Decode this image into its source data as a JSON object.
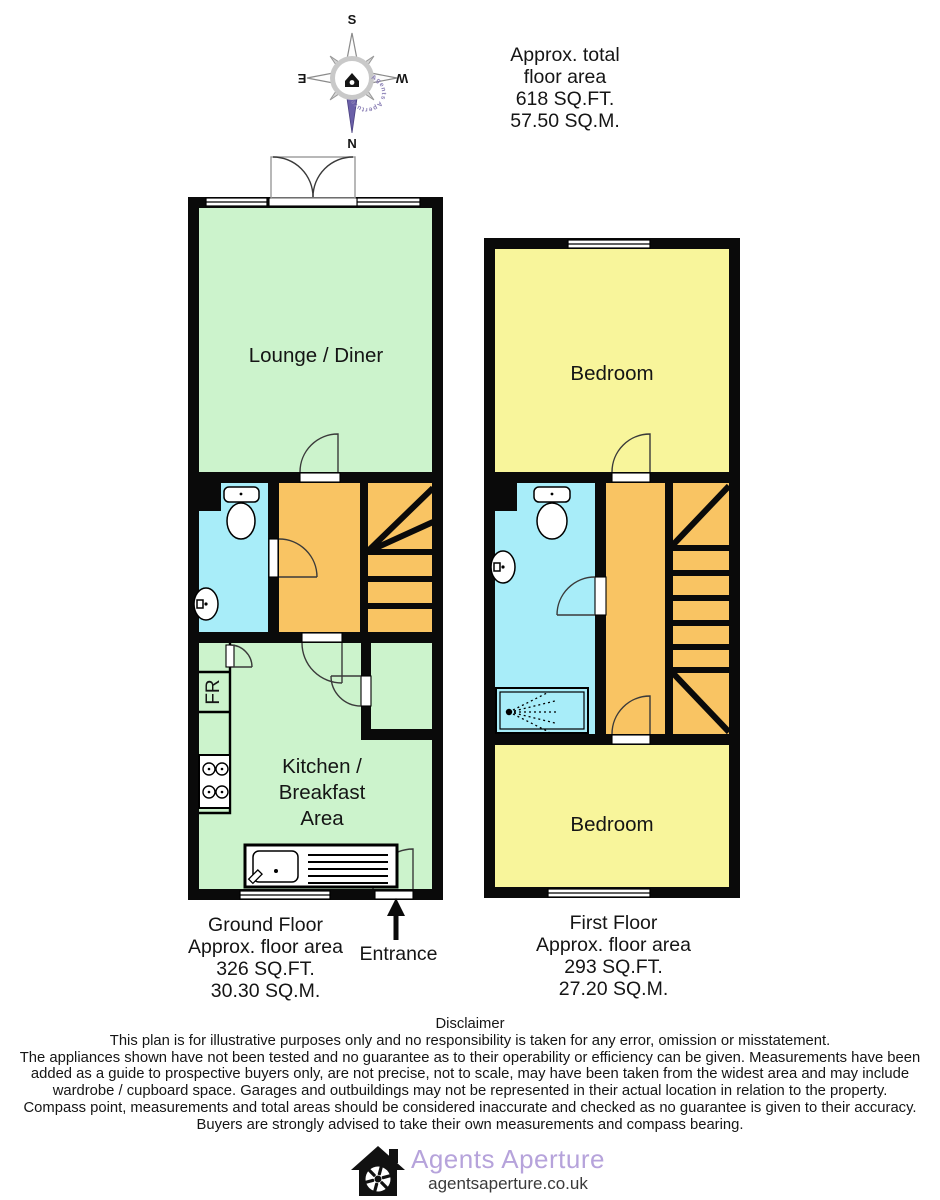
{
  "header": {
    "lines": [
      "Approx. total",
      "floor area",
      "618 SQ.FT.",
      "57.50 SQ.M."
    ]
  },
  "compass": {
    "north": "N",
    "south": "S",
    "east": "E",
    "west": "W",
    "ring_text": "Agents Aperture",
    "needle_color": "#6a5fa8"
  },
  "colors": {
    "wall": "#0a0a0a",
    "green": "#ccf3cc",
    "yellow": "#f8f59b",
    "cyan": "#a8edf9",
    "orange": "#f9c463"
  },
  "ground_floor": {
    "lounge_label": "Lounge / Diner",
    "kitchen_label_lines": [
      "Kitchen /",
      "Breakfast",
      "Area"
    ],
    "fridge_label": "FR",
    "caption_lines": [
      "Ground Floor",
      "Approx. floor area",
      "326 SQ.FT.",
      "30.30 SQ.M."
    ],
    "entrance_label": "Entrance"
  },
  "first_floor": {
    "bedroom_front_label": "Bedroom",
    "bedroom_back_label": "Bedroom",
    "caption_lines": [
      "First Floor",
      "Approx. floor area",
      "293 SQ.FT.",
      "27.20 SQ.M."
    ]
  },
  "disclaimer": {
    "title": "Disclaimer",
    "lines": [
      "This plan is for illustrative purposes only and no responsibility is taken for any error, omission or misstatement.",
      "The appliances shown have not been tested and no guarantee as to their operability or efficiency can be given. Measurements have been",
      "added as a guide to prospective buyers only, are not precise, not to scale, may have been taken from the widest area and may include",
      "wardrobe / cupboard space. Garages and outbuildings may not be represented in their actual location in relation to the property.",
      "Compass point, measurements and total areas should be considered inaccurate and checked as no guarantee is given to their accuracy.",
      "Buyers are strongly advised to take their own measurements and compass bearing."
    ]
  },
  "footer": {
    "brand": "Agents Aperture",
    "url": "agentsaperture.co.uk",
    "brand_color": "#b6a3db"
  }
}
